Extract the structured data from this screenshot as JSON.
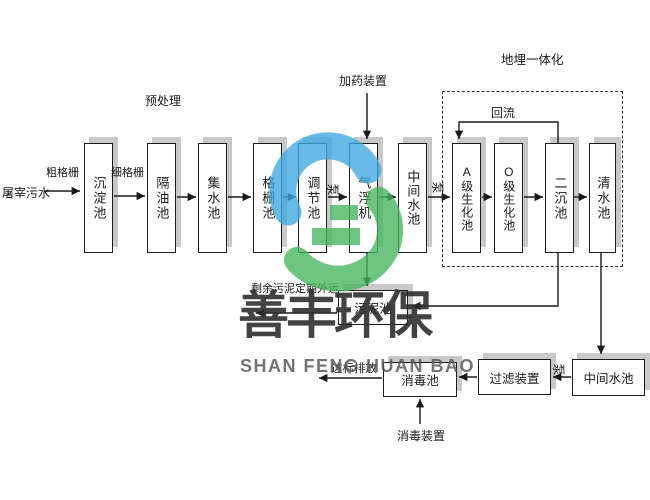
{
  "diagram": {
    "source": "屠宰污水",
    "pretreatment_label": "预处理",
    "coarse_screen": "粗格栅",
    "fine_screen": "细格栅",
    "dosing_device": "加药装置",
    "buried_integration_label": "地埋一体化",
    "reflux_label": "回流",
    "pump": "泵",
    "main_tanks": [
      {
        "label": "沉淀池"
      },
      {
        "label": "隔油池"
      },
      {
        "label": "集水池"
      },
      {
        "label": "格栅池"
      },
      {
        "label": "调节池"
      },
      {
        "label": "气浮机"
      },
      {
        "label": "中间水池"
      },
      {
        "label": "A级生化池"
      },
      {
        "label": "O级生化池"
      },
      {
        "label": "二沉池"
      },
      {
        "label": "清水池"
      }
    ],
    "sludge_tank": "污泥池",
    "sludge_disposal_note": "剩余污泥定期外运",
    "intermediate_tank_2": "中间水池",
    "filter_device": "过滤装置",
    "disinfection_tank": "消毒池",
    "disinfection_device": "消毒装置",
    "discharge_label": "达标排放"
  },
  "watermark": {
    "company_cn": "善丰环保",
    "company_en": "SHAN FENG HUAN BAO",
    "logo_blue": "#3FA8E0",
    "logo_green": "#44B65B"
  },
  "colors": {
    "line": "#1A1A1A",
    "box_shadow": "#C9C9C9"
  }
}
